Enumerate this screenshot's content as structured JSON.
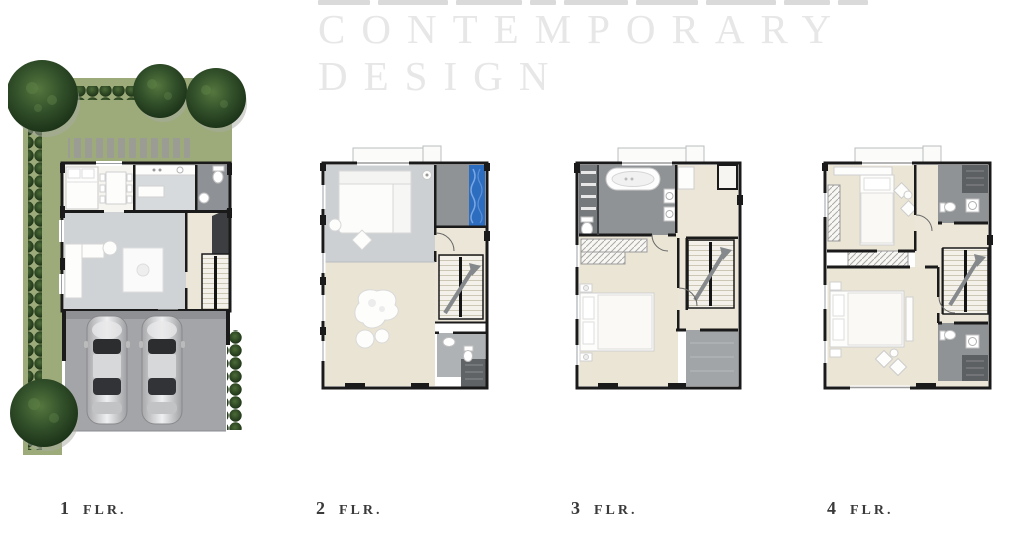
{
  "header": {
    "title_line1": "CONTEMPORARY",
    "title_line2": "DESIGN",
    "title_color": "#e7e7e7"
  },
  "floors": [
    {
      "num": "1",
      "label": "FLR."
    },
    {
      "num": "2",
      "label": "FLR."
    },
    {
      "num": "3",
      "label": "FLR."
    },
    {
      "num": "4",
      "label": "FLR."
    }
  ],
  "colors": {
    "background": "#ffffff",
    "label_text": "#3a3a3a",
    "lawn_green": "#9dab7b",
    "tree_green": "#2c4a22",
    "wall_black": "#1a1a1a",
    "floor_gray": "#ced2d5",
    "floor_cream": "#eae5d5",
    "bath_gray": "#8f9396",
    "closet_dark": "#606366",
    "garage_gray": "#a4a5a8",
    "pool_blue": "#2d6dc0",
    "car_silver": "#d7d8da"
  }
}
